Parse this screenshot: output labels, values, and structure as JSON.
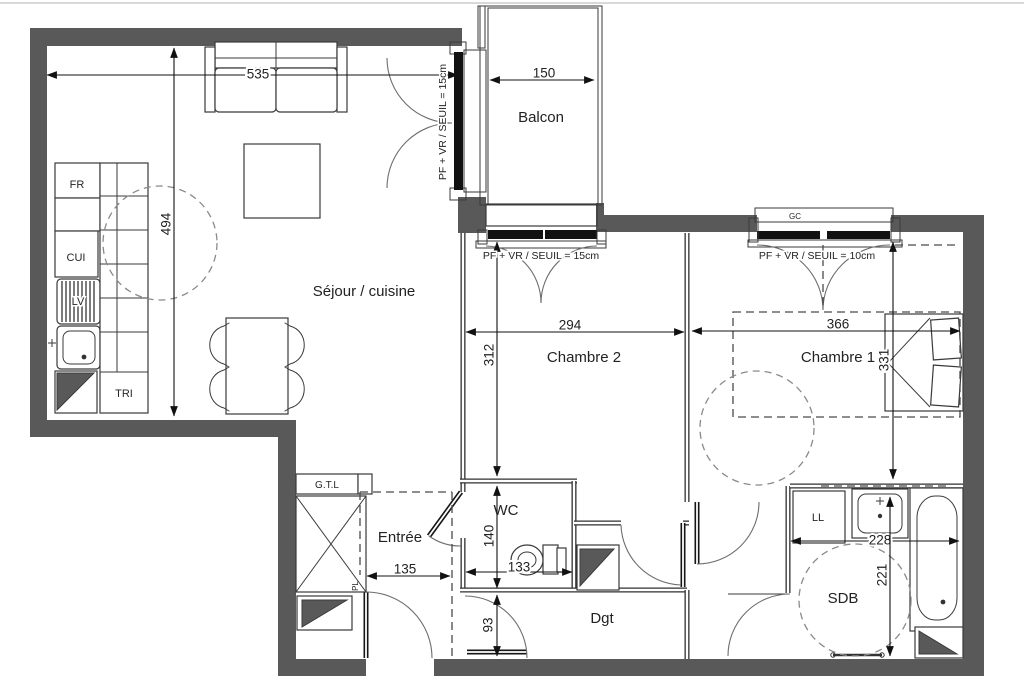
{
  "rooms": {
    "sejour": "Séjour / cuisine",
    "balcon": "Balcon",
    "chambre2": "Chambre 2",
    "chambre1": "Chambre 1",
    "wc": "WC",
    "entree": "Entrée",
    "dgt": "Dgt",
    "sdb": "SDB"
  },
  "fixtures": {
    "fr": "FR",
    "cui": "CUI",
    "lv": "LV",
    "tri": "TRI",
    "gtl": "G.T.L",
    "pl": "PL",
    "ll": "LL",
    "gc": "GC"
  },
  "dims": {
    "d535": "535",
    "d494": "494",
    "d150": "150",
    "d294": "294",
    "d312": "312",
    "d366": "366",
    "d331": "331",
    "d140": "140",
    "d133": "133",
    "d135": "135",
    "d93": "93",
    "d228": "228",
    "d221": "221"
  },
  "notes": {
    "balcony_window": "PF + VR / SEUIL = 15cm",
    "chambre2_window": "PF + VR / SEUIL = 15cm",
    "chambre1_window": "PF + VR / SEUIL = 10cm"
  },
  "colors": {
    "wall": "#595959",
    "line": "#2a2a2a",
    "dash": "#808080",
    "background": "#ffffff"
  }
}
